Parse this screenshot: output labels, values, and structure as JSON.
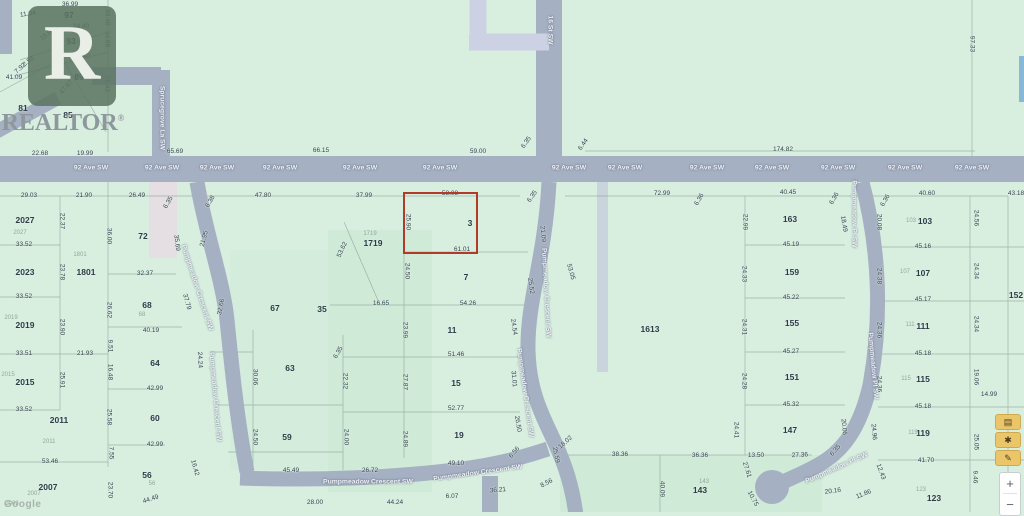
{
  "map": {
    "colors": {
      "background": "#d8efe0",
      "road": "#a6b0c3",
      "pale_road": "#ccd2e3",
      "highlight": "#b23a28",
      "dim_text": "#33424c",
      "lot_text": "#2d3b45",
      "tool_button": "#eac56a"
    },
    "watermark": {
      "logo_letter": "R",
      "text": "REALTOR",
      "reg": "®"
    },
    "attribution": "Google",
    "highlight": {
      "x": 403,
      "y": 192,
      "w": 71,
      "h": 58,
      "lot": "3",
      "top_dim": "58.08",
      "bottom_dim": "61.01",
      "side_dim": "25.90"
    },
    "street_names": {
      "avenue": "92 Ave SW",
      "street": "16 St SW",
      "lane": "Sprucegrove La SW",
      "crescent": "Pumpmeadow Crescent SW",
      "place": "Pumpmeadow Pl SW"
    },
    "road_labels": [
      [
        "92 Ave SW",
        91,
        169,
        0
      ],
      [
        "92 Ave SW",
        162,
        169,
        0
      ],
      [
        "92 Ave SW",
        217,
        169,
        0
      ],
      [
        "92 Ave SW",
        280,
        169,
        0
      ],
      [
        "92 Ave SW",
        360,
        169,
        0
      ],
      [
        "92 Ave SW",
        440,
        169,
        0
      ],
      [
        "92 Ave SW",
        569,
        169,
        0
      ],
      [
        "92 Ave SW",
        625,
        169,
        0
      ],
      [
        "92 Ave SW",
        707,
        169,
        0
      ],
      [
        "92 Ave SW",
        772,
        169,
        0
      ],
      [
        "92 Ave SW",
        838,
        169,
        0
      ],
      [
        "92 Ave SW",
        905,
        169,
        0
      ],
      [
        "92 Ave SW",
        972,
        169,
        0
      ],
      [
        "16 St SW",
        549,
        30,
        90
      ],
      [
        "Sprucegrove La SW",
        161,
        118,
        90
      ],
      [
        "Pumpmeadow Crescent SW",
        196,
        288,
        72
      ],
      [
        "Pumpmeadow Crescent SW",
        214,
        397,
        85
      ],
      [
        "Pumpmeadow Crescent SW",
        545,
        293,
        87
      ],
      [
        "Pumpmeadow Crescent SW",
        524,
        393,
        82
      ],
      [
        "Pumpmeadow Crescent SW",
        368,
        483,
        0
      ],
      [
        "Pumpmeadow Crescent SW",
        478,
        474,
        -8
      ],
      [
        "Pumpmeadow Pl SW",
        853,
        214,
        90
      ],
      [
        "Pumpmeadow Pl SW",
        872,
        366,
        85
      ],
      [
        "Pumpmeadow Pl SW",
        837,
        469,
        -24
      ]
    ],
    "dimensions": [
      [
        "36.99",
        70,
        5,
        0
      ],
      [
        "11.04",
        28,
        15,
        -8
      ],
      [
        "34.40",
        81,
        27,
        0
      ],
      [
        "30.48",
        106,
        17,
        90
      ],
      [
        "15.06",
        48,
        35,
        -38
      ],
      [
        "34.88",
        106,
        39,
        90
      ],
      [
        "34.40",
        82,
        57,
        0
      ],
      [
        "2.93",
        29,
        62,
        -40
      ],
      [
        "7.92",
        21,
        69,
        -42
      ],
      [
        "41.09",
        14,
        78,
        0
      ],
      [
        "47.67",
        67,
        88,
        -48
      ],
      [
        "29.42",
        106,
        84,
        90
      ],
      [
        "22.68",
        40,
        154,
        0
      ],
      [
        "19.99",
        85,
        154,
        0
      ],
      [
        "65.69",
        175,
        152,
        0
      ],
      [
        "66.15",
        321,
        151,
        0
      ],
      [
        "59.00",
        478,
        152,
        0
      ],
      [
        "6.35",
        527,
        143,
        -55
      ],
      [
        "6.44",
        584,
        145,
        -55
      ],
      [
        "174.82",
        783,
        150,
        0
      ],
      [
        "97.33",
        971,
        44,
        90
      ],
      [
        "29.03",
        29,
        196,
        0
      ],
      [
        "21.90",
        84,
        196,
        0
      ],
      [
        "26.49",
        137,
        196,
        0
      ],
      [
        "6.35",
        169,
        203,
        -60
      ],
      [
        "22.37",
        61,
        221,
        90
      ],
      [
        "36.00",
        108,
        236,
        90
      ],
      [
        "33.52",
        24,
        245,
        0
      ],
      [
        "23.78",
        61,
        272,
        90
      ],
      [
        "32.37",
        145,
        274,
        0
      ],
      [
        "33.52",
        24,
        297,
        0
      ],
      [
        "26.62",
        108,
        310,
        90
      ],
      [
        "23.90",
        61,
        327,
        90
      ],
      [
        "40.19",
        151,
        331,
        0
      ],
      [
        "9.51",
        109,
        346,
        90
      ],
      [
        "33.51",
        24,
        354,
        0
      ],
      [
        "21.93",
        85,
        354,
        0
      ],
      [
        "16.48",
        109,
        372,
        90
      ],
      [
        "25.91",
        61,
        380,
        90
      ],
      [
        "42.99",
        155,
        389,
        0
      ],
      [
        "33.52",
        24,
        410,
        0
      ],
      [
        "25.58",
        108,
        417,
        90
      ],
      [
        "42.99",
        155,
        445,
        0
      ],
      [
        "7.55",
        110,
        453,
        90
      ],
      [
        "53.46",
        50,
        462,
        0
      ],
      [
        "23.70",
        109,
        490,
        90
      ],
      [
        "44.49",
        151,
        500,
        -18
      ],
      [
        "16.42",
        194,
        468,
        75
      ],
      [
        "35.69",
        176,
        243,
        83
      ],
      [
        "21.95",
        205,
        239,
        -75
      ],
      [
        "37.79",
        186,
        302,
        75
      ],
      [
        "32.66",
        222,
        307,
        -78
      ],
      [
        "24.24",
        199,
        360,
        87
      ],
      [
        "30.06",
        254,
        377,
        90
      ],
      [
        "24.50",
        254,
        437,
        90
      ],
      [
        "47.80",
        263,
        196,
        0
      ],
      [
        "6.38",
        211,
        202,
        -60
      ],
      [
        "37.99",
        364,
        196,
        0
      ],
      [
        "53.62",
        343,
        250,
        -65
      ],
      [
        "58.08",
        450,
        194,
        0
      ],
      [
        "25.90",
        407,
        222,
        90
      ],
      [
        "61.01",
        462,
        250,
        0
      ],
      [
        "24.50",
        406,
        271,
        90
      ],
      [
        "16.65",
        381,
        304,
        0
      ],
      [
        "54.26",
        468,
        304,
        0
      ],
      [
        "23.99",
        404,
        330,
        90
      ],
      [
        "27.87",
        404,
        382,
        90
      ],
      [
        "24.89",
        404,
        439,
        90
      ],
      [
        "22.32",
        344,
        381,
        90
      ],
      [
        "6.35",
        339,
        353,
        -60
      ],
      [
        "24.00",
        345,
        437,
        90
      ],
      [
        "51.46",
        456,
        355,
        0
      ],
      [
        "52.77",
        456,
        409,
        0
      ],
      [
        "45.49",
        291,
        471,
        0
      ],
      [
        "26.72",
        370,
        471,
        0
      ],
      [
        "49.10",
        456,
        464,
        0
      ],
      [
        "28.00",
        315,
        503,
        0
      ],
      [
        "44.24",
        395,
        503,
        0
      ],
      [
        "6.07",
        452,
        497,
        0
      ],
      [
        "36.21",
        498,
        491,
        -5
      ],
      [
        "8.56",
        547,
        484,
        -28
      ],
      [
        "25.59",
        555,
        455,
        78
      ],
      [
        "6.35",
        533,
        197,
        -55
      ],
      [
        "21.09",
        542,
        234,
        85
      ],
      [
        "25.52",
        530,
        286,
        82
      ],
      [
        "24.54",
        513,
        327,
        82
      ],
      [
        "31.01",
        513,
        379,
        85
      ],
      [
        "26.50",
        517,
        424,
        80
      ],
      [
        "6.56",
        515,
        453,
        -50
      ],
      [
        "18.02",
        566,
        443,
        -42
      ],
      [
        "53.05",
        570,
        272,
        75
      ],
      [
        "72.99",
        662,
        194,
        0
      ],
      [
        "40.45",
        788,
        193,
        0
      ],
      [
        "6.36",
        700,
        200,
        -60
      ],
      [
        "6.36",
        835,
        199,
        -60
      ],
      [
        "22.99",
        744,
        222,
        90
      ],
      [
        "18.49",
        843,
        224,
        80
      ],
      [
        "24.33",
        743,
        274,
        90
      ],
      [
        "24.31",
        743,
        327,
        90
      ],
      [
        "24.28",
        743,
        381,
        90
      ],
      [
        "24.41",
        735,
        430,
        90
      ],
      [
        "45.19",
        791,
        245,
        0
      ],
      [
        "45.22",
        791,
        298,
        0
      ],
      [
        "45.27",
        791,
        352,
        0
      ],
      [
        "45.32",
        791,
        405,
        0
      ],
      [
        "38.36",
        620,
        455,
        0
      ],
      [
        "36.36",
        700,
        456,
        0
      ],
      [
        "13.50",
        756,
        456,
        0
      ],
      [
        "27.36",
        800,
        456,
        -3
      ],
      [
        "20.06",
        843,
        427,
        85
      ],
      [
        "6.35",
        836,
        451,
        -50
      ],
      [
        "27.61",
        746,
        470,
        72
      ],
      [
        "40.09",
        661,
        489,
        90
      ],
      [
        "10.75",
        752,
        499,
        62
      ],
      [
        "12.43",
        880,
        472,
        70
      ],
      [
        "11.86",
        864,
        495,
        -22
      ],
      [
        "20.16",
        833,
        492,
        -8
      ],
      [
        "24.96",
        873,
        432,
        85
      ],
      [
        "40.60",
        927,
        194,
        0
      ],
      [
        "43.18",
        1016,
        194,
        0
      ],
      [
        "6.36",
        886,
        201,
        -60
      ],
      [
        "20.08",
        878,
        222,
        90
      ],
      [
        "24.56",
        975,
        218,
        90
      ],
      [
        "45.16",
        923,
        247,
        0
      ],
      [
        "24.38",
        878,
        276,
        90
      ],
      [
        "24.34",
        975,
        271,
        90
      ],
      [
        "45.17",
        923,
        300,
        0
      ],
      [
        "24.36",
        878,
        330,
        90
      ],
      [
        "24.34",
        975,
        324,
        90
      ],
      [
        "45.18",
        923,
        354,
        0
      ],
      [
        "24.36",
        878,
        384,
        90
      ],
      [
        "19.06",
        975,
        377,
        90
      ],
      [
        "14.99",
        989,
        395,
        0
      ],
      [
        "45.18",
        923,
        407,
        0
      ],
      [
        "25.05",
        975,
        442,
        90
      ],
      [
        "41.70",
        926,
        461,
        0
      ],
      [
        "9.46",
        974,
        477,
        90
      ]
    ],
    "lot_numbers": [
      [
        "97",
        69,
        15
      ],
      [
        "93",
        71,
        41
      ],
      [
        "89",
        79,
        77
      ],
      [
        "85",
        68,
        115
      ],
      [
        "81",
        23,
        108
      ],
      [
        "2027",
        25,
        220
      ],
      [
        "2023",
        25,
        272
      ],
      [
        "2019",
        25,
        325
      ],
      [
        "2015",
        25,
        382
      ],
      [
        "2011",
        59,
        420
      ],
      [
        "2007",
        48,
        487
      ],
      [
        "1801",
        86,
        272
      ],
      [
        "72",
        143,
        236
      ],
      [
        "68",
        147,
        305
      ],
      [
        "64",
        155,
        363
      ],
      [
        "60",
        155,
        418
      ],
      [
        "56",
        147,
        475
      ],
      [
        "67",
        275,
        308
      ],
      [
        "63",
        290,
        368
      ],
      [
        "59",
        287,
        437
      ],
      [
        "35",
        322,
        309
      ],
      [
        "1719",
        373,
        243
      ],
      [
        "3",
        470,
        223
      ],
      [
        "7",
        466,
        277
      ],
      [
        "11",
        452,
        330
      ],
      [
        "15",
        456,
        383
      ],
      [
        "19",
        459,
        435
      ],
      [
        "1613",
        650,
        329
      ],
      [
        "163",
        790,
        219
      ],
      [
        "159",
        792,
        272
      ],
      [
        "155",
        792,
        323
      ],
      [
        "151",
        792,
        377
      ],
      [
        "147",
        790,
        430
      ],
      [
        "143",
        700,
        490
      ],
      [
        "103",
        925,
        221
      ],
      [
        "107",
        923,
        273
      ],
      [
        "111",
        923,
        326
      ],
      [
        "115",
        923,
        379
      ],
      [
        "119",
        923,
        433
      ],
      [
        "123",
        934,
        498
      ],
      [
        "152",
        1016,
        295
      ]
    ],
    "gray_lot_numbers": [
      [
        "2027",
        20,
        233
      ],
      [
        "2019",
        11,
        318
      ],
      [
        "2015",
        8,
        375
      ],
      [
        "2011",
        49,
        442
      ],
      [
        "2007",
        34,
        494
      ],
      [
        "2003",
        12,
        504
      ],
      [
        "1801",
        80,
        255
      ],
      [
        "68",
        142,
        315
      ],
      [
        "56",
        152,
        484
      ],
      [
        "1719",
        370,
        234
      ],
      [
        "143",
        704,
        482
      ],
      [
        "103",
        911,
        221
      ],
      [
        "107",
        905,
        272
      ],
      [
        "111",
        910,
        325
      ],
      [
        "115",
        906,
        379
      ],
      [
        "119",
        913,
        433
      ],
      [
        "123",
        921,
        490
      ]
    ],
    "controls": {
      "tool_buttons": [
        {
          "name": "layers-tool-button",
          "glyph": "▤"
        },
        {
          "name": "shape-tool-button",
          "glyph": "✱"
        },
        {
          "name": "draw-tool-button",
          "glyph": "✎"
        }
      ],
      "zoom_in": "+",
      "zoom_out": "−"
    }
  }
}
